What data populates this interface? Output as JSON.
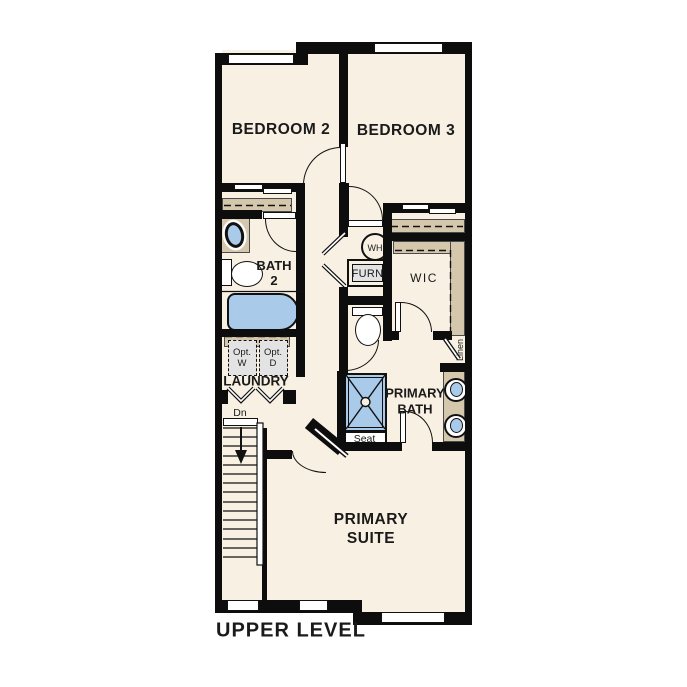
{
  "plan_title": "UPPER LEVEL",
  "rooms": {
    "bedroom2": {
      "label": "BEDROOM 2"
    },
    "bedroom3": {
      "label": "BEDROOM 3"
    },
    "bath2": {
      "line1": "BATH",
      "line2": "2"
    },
    "laundry": {
      "label": "LAUNDRY"
    },
    "wic": {
      "label": "WIC"
    },
    "primary_bath": {
      "line1": "PRIMARY",
      "line2": "BATH"
    },
    "primary_suite": {
      "line1": "PRIMARY",
      "line2": "SUITE"
    }
  },
  "fixtures": {
    "water_heater": "WH",
    "furnace": "FURN",
    "shower_seat": "Seat",
    "stairs_direction": "Dn",
    "linen_closet": "Linen",
    "optional_washer": {
      "line1": "Opt.",
      "line2": "W"
    },
    "optional_dryer": {
      "line1": "Opt.",
      "line2": "D"
    }
  },
  "colors": {
    "background": "#ffffff",
    "floor": "#f8f0e3",
    "wall": "#0d0d0d",
    "counter_tan": "#d4c7ac",
    "fixture_blue": "#a9cbe9",
    "appliance_gray": "#e3e3e3"
  }
}
